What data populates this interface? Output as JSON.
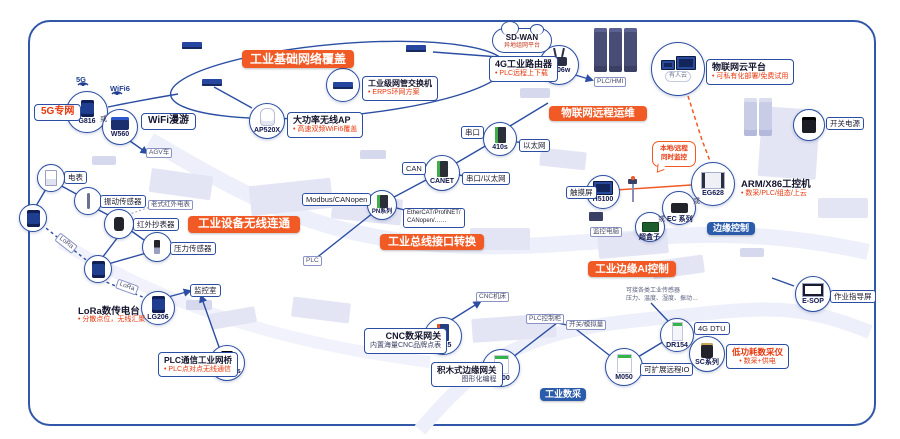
{
  "colors": {
    "banner_orange": "#f15a24",
    "banner_blue": "#2b5cab",
    "line_blue": "#2b4ea2",
    "accent_red": "#e8380d"
  },
  "topleft": {
    "net5g": "5G专网",
    "badge5g": "5G",
    "badgewifi6": "WiFi6",
    "dev1": "G816",
    "or": "或",
    "dev2": "W560",
    "roaming": "WiFi漫游",
    "agv": "AGV车"
  },
  "banners": {
    "coverage": "工业基础网络覆盖",
    "remote": "物联网远程运维",
    "wireless": "工业设备无线连通",
    "bus": "工业总线接口转换",
    "edgeai": "工业边缘AI控制",
    "edgectl": "边缘控制",
    "daq": "工业数采"
  },
  "sensors": {
    "meter": "电表",
    "vibration": "振动传感器",
    "infrared": "红外抄表器",
    "pressure": "压力传感器",
    "old_meter": "老式红外电表",
    "room": "监控室",
    "lora_a": "LoRa",
    "lora_b": "LoRa"
  },
  "lora": {
    "title": "LoRa数传电台",
    "bullet": "• 分散点位，无线汇聚",
    "model": "LG206"
  },
  "bridge": {
    "title": "PLC通信工业网桥",
    "bullet": "• PLC点对点无线通信",
    "model": "GW208s"
  },
  "ring": {
    "sw_title": "工业级网管交换机",
    "sw_bullet": "• ERPS环网方案",
    "ap_title": "大功率无线AP",
    "ap_bullet": "• 高速双频WiFi6覆盖",
    "ap_model": "AP520X"
  },
  "cloud": {
    "sdwan": "SD-WAN",
    "sdwan_sub": "异地组网平台",
    "r_title": "4G工业路由器",
    "r_bullet": "• PLC远程上下载",
    "r_model": "G806w",
    "plchmi": "PLC/HMI",
    "p_title": "物联网云平台",
    "p_bullet": "• 可私有化部署/免费试用",
    "cloud_name": "有人云",
    "psu": "开关电源"
  },
  "edge": {
    "b1": "本地/远程",
    "b2": "同时监控",
    "touch": "触摸屏",
    "touch_model": "H5100",
    "desk": "监控电脑",
    "ipc_title": "ARM/X86工控机",
    "ipc_bullet": "• 数采/PLC/组态/上云",
    "ipc_model": "EG628",
    "or1": "或",
    "ec": "EC 系列",
    "or2": "或",
    "box": "超盒子"
  },
  "bus": {
    "serial": "串口",
    "eth": "以太网",
    "n410": "410s",
    "can": "CAN",
    "se": "串口/以太网",
    "canet": "CANET",
    "modbus": "Modbus/CANopen",
    "pn": "PN系列",
    "proto1": "EtherCAT/ProfiNET/",
    "proto2": "CANopen/……",
    "plc": "PLC"
  },
  "daq": {
    "cnc_t": "CNC数采网关",
    "cnc_s": "内置海量CNC品牌点表",
    "cnc_m": "N725",
    "machine": "CNC机床",
    "blk_t": "积木式边缘网关",
    "blk_s": "图形化编程",
    "blk_m": "M300",
    "cab": "PLC控制柜",
    "sig": "开关/模拟量",
    "io_m": "M050",
    "io_l": "可扩展远程IO",
    "dtu": "4G DTU",
    "dtu_m": "DR154",
    "lp_t": "低功耗数采仪",
    "lp_b": "• 数采+供电",
    "lp_m": "SC系列",
    "esop_m": "E-SOP",
    "esop_l": "作业指导屏",
    "note1": "可接各类工业传感器",
    "note2": "压力、温度、湿度、振动…"
  }
}
